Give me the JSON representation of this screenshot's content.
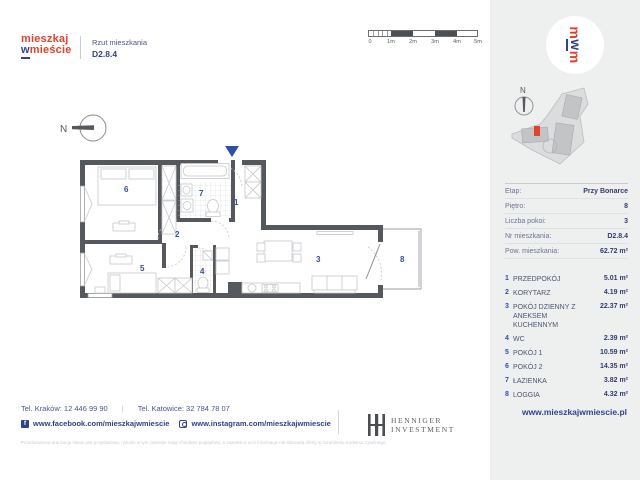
{
  "header": {
    "logo_line1": "mieszkaj",
    "logo_w": "w",
    "logo_line2": "mieście",
    "doc_type": "Rzut mieszkania",
    "unit_code": "D2.8.4"
  },
  "scalebar": {
    "labels": [
      "0",
      "1m",
      "2m",
      "3m",
      "4m",
      "5m"
    ]
  },
  "plan": {
    "compass_label": "N",
    "room_numbers": [
      "1",
      "2",
      "3",
      "4",
      "5",
      "6",
      "7",
      "8"
    ]
  },
  "sidebar": {
    "logo_m1": "m",
    "logo_w": "w",
    "logo_m2": "m",
    "map_compass_label": "N",
    "details": [
      {
        "label": "Etap:",
        "value": "Przy Bonarce"
      },
      {
        "label": "Piętro:",
        "value": "8"
      },
      {
        "label": "Liczba pokoi:",
        "value": "3"
      },
      {
        "label": "Nr mieszkania:",
        "value": "D2.8.4"
      },
      {
        "label": "Pow. mieszkania:",
        "value": "62.72 m²"
      }
    ],
    "rooms": [
      {
        "num": "1",
        "name": "PRZEDPOKÓJ",
        "area": "5.01 m²"
      },
      {
        "num": "2",
        "name": "KORYTARZ",
        "area": "4.19 m²"
      },
      {
        "num": "3",
        "name": "POKÓJ DZIENNY Z ANEKSEM KUCHENNYM",
        "area": "22.37 m²"
      },
      {
        "num": "4",
        "name": "WC",
        "area": "2.39 m²"
      },
      {
        "num": "5",
        "name": "POKÓJ 1",
        "area": "10.59 m²"
      },
      {
        "num": "6",
        "name": "POKÓJ 2",
        "area": "14.35 m²"
      },
      {
        "num": "7",
        "name": "ŁAZIENKA",
        "area": "3.82 m²"
      },
      {
        "num": "8",
        "name": "LOGGIA",
        "area": "4.32 m²"
      }
    ],
    "website": "www.mieszkajwmiescie.pl"
  },
  "footer": {
    "phone_krakow": "Tel. Kraków: 12 446 99 90",
    "phone_katowice": "Tel. Katowice: 32 784 78 07",
    "facebook_icon_letter": "f",
    "facebook": "www.facebook.com/mieszkajwmiescie",
    "instagram": "www.instagram.com/mieszkajwmiescie",
    "disclaimer": "Przedstawiona aranżacja lokalu jest przykładowa, rysunki w tym zakresie mają charakter poglądowy, a zawarte w nich informacje nie stanowią oferty w rozumieniu Kodeksu Cywilnego.",
    "brand_line1": "HENNIGER",
    "brand_line2": "INVESTMENT"
  },
  "colors": {
    "brand_red": "#e8402c",
    "brand_navy": "#33408f",
    "plan_number_blue": "#2d4fae",
    "wall_gray": "#55585d",
    "sidebar_bg": "#eef0f0"
  }
}
